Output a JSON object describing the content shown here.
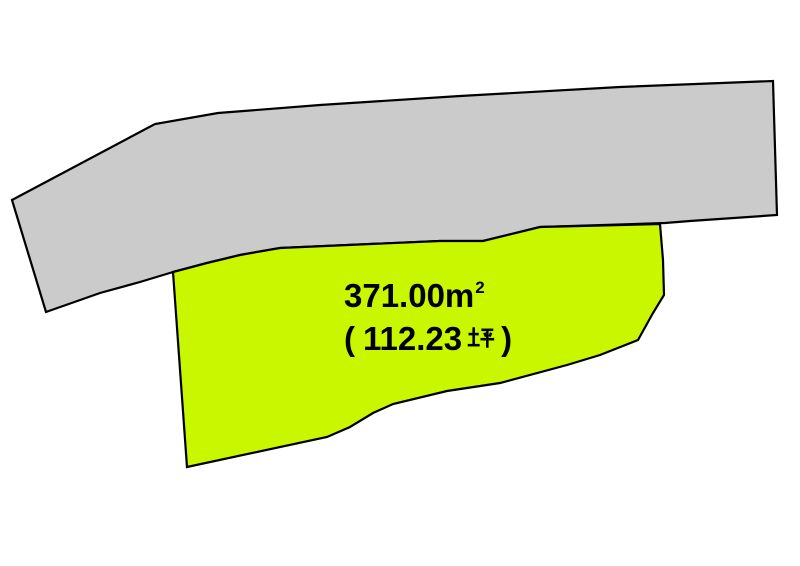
{
  "canvas": {
    "width": 800,
    "height": 566,
    "background": "#ffffff"
  },
  "diagram": {
    "type": "land-plot-map",
    "outline_color": "#000000",
    "adjacent_parcel": {
      "fill": "#cbcbcb",
      "points": "12,200 155,124 218,113 320,105 460,96 620,87 773,81 777,215 690,221 665,223 540,227 483,241 440,241 280,248 240,255 207,263 173,272 140,282 100,293 46,312"
    },
    "main_parcel": {
      "fill": "#c8f700",
      "points": "173,272 207,263 240,255 280,248 440,241 483,241 540,227 660,224 663,260 664,295 653,313 638,340 600,355 567,365 500,383 447,391 393,404 373,413 350,427 327,437 187,467"
    }
  },
  "label": {
    "area_sqm": "371.00㎡",
    "area_tsubo": "（112.23坪）",
    "text_color": "#000000",
    "display": {
      "line1_base": "371.00m",
      "line1_sup": "2",
      "line2_open": "(",
      "line2_number": "112.23",
      "line2_unit": "坪",
      "line2_close": ")"
    }
  }
}
